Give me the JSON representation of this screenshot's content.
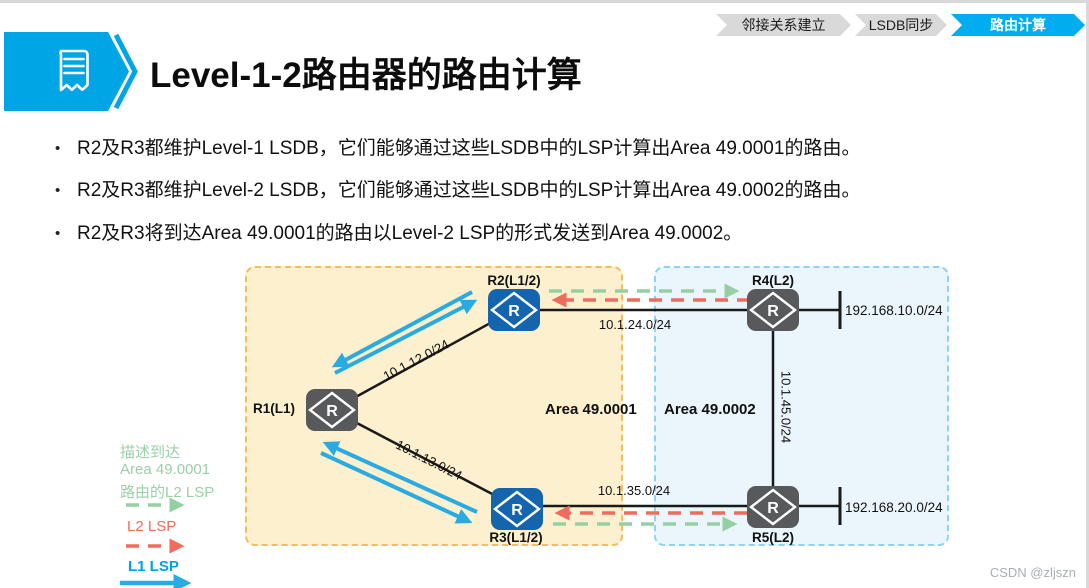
{
  "breadcrumb": {
    "items": [
      {
        "label": "邻接关系建立",
        "active": false
      },
      {
        "label": "LSDB同步",
        "active": false
      },
      {
        "label": "路由计算",
        "active": true
      }
    ]
  },
  "header": {
    "title": "Level-1-2路由器的路由计算"
  },
  "bullets": [
    "R2及R3都维护Level-1 LSDB，它们能够通过这些LSDB中的LSP计算出Area 49.0001的路由。",
    "R2及R3都维护Level-2 LSDB，它们能够通过这些LSDB中的LSP计算出Area 49.0002的路由。",
    "R2及R3将到达Area 49.0001的路由以Level-2 LSP的形式发送到Area 49.0002。"
  ],
  "diagram": {
    "router_glyph": "R",
    "areas": {
      "area1": {
        "label": "Area 49.0001"
      },
      "area2": {
        "label": "Area 49.0002"
      }
    },
    "nodes": {
      "r1": {
        "label": "R1(L1)",
        "type": "level-1"
      },
      "r2": {
        "label": "R2(L1/2)",
        "type": "level-1-2"
      },
      "r3": {
        "label": "R3(L1/2)",
        "type": "level-1-2"
      },
      "r4": {
        "label": "R4(L2)",
        "type": "level-2"
      },
      "r5": {
        "label": "R5(L2)",
        "type": "level-2"
      }
    },
    "links": {
      "r1_r2": {
        "label": "10.1.12.0/24"
      },
      "r1_r3": {
        "label": "10.1.13.0/24"
      },
      "r2_r4": {
        "label": "10.1.24.0/24"
      },
      "r3_r5": {
        "label": "10.1.35.0/24"
      },
      "r4_r5": {
        "label": "10.1.45.0/24"
      }
    },
    "stubs": {
      "r4": {
        "label": "192.168.10.0/24"
      },
      "r5": {
        "label": "192.168.20.0/24"
      }
    }
  },
  "legend": {
    "green_line1": "描述到达",
    "green_line2": "Area 49.0001",
    "green_line3": "路由的L2 LSP",
    "red_label": "L2 LSP",
    "blue_label": "L1 LSP"
  },
  "watermark": "CSDN @zljszn",
  "colors": {
    "accent_blue": "#00AEEF",
    "router_blue": "#1565AE",
    "router_gray": "#58595B",
    "l1_lsp_arrow": "#29ABE2",
    "l2_lsp_arrow": "#ED6C5D",
    "area_route_lsp_arrow": "#95CFA3",
    "area1_fill": "#FDF0CE",
    "area1_border": "#F2BE5C",
    "area2_fill": "#EBF6FC",
    "area2_border": "#8ED3F0"
  }
}
